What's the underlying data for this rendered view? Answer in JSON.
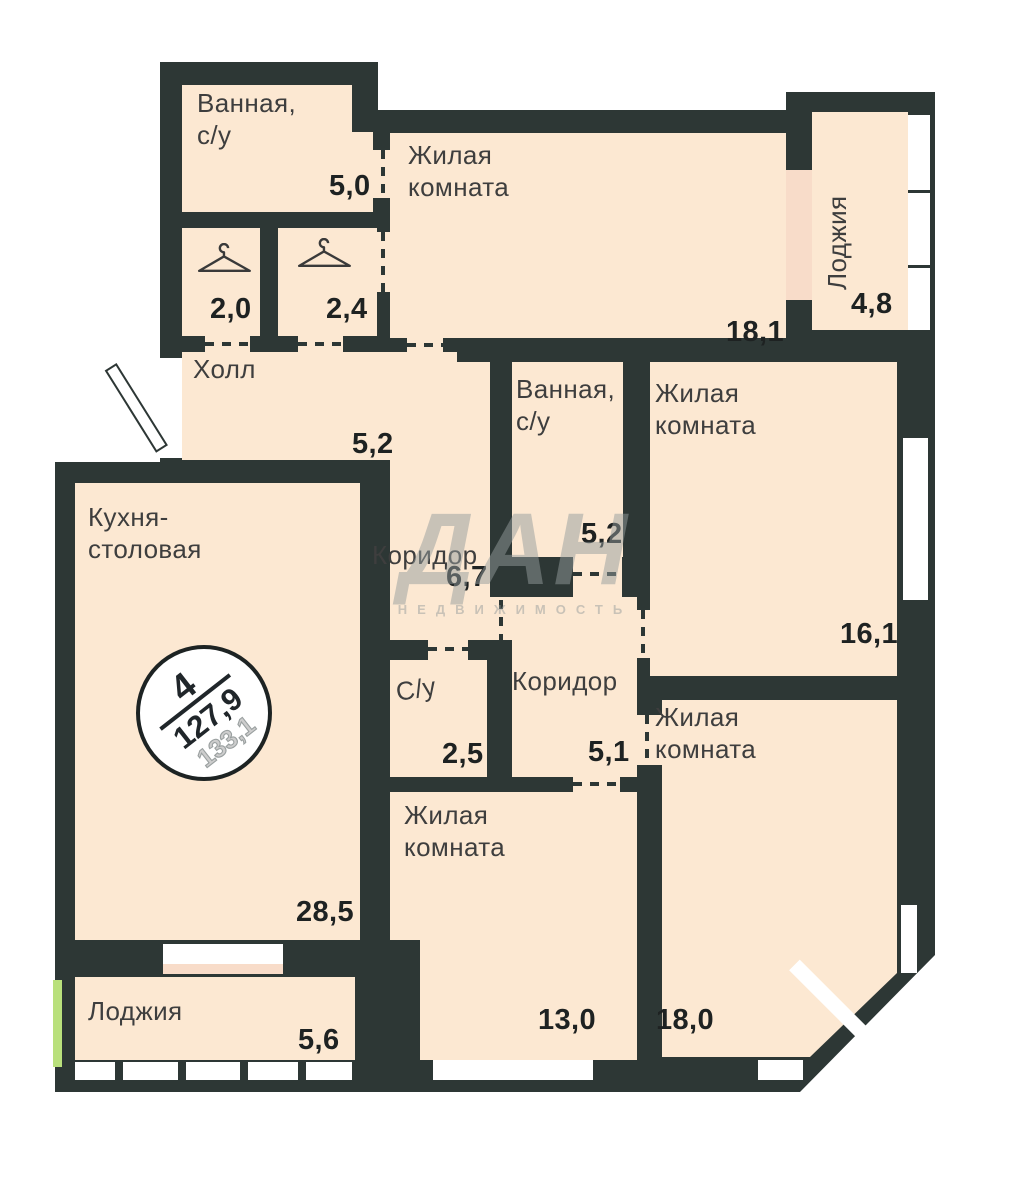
{
  "watermark": {
    "logo": "ДАН",
    "subtitle": "НЕДВИЖИМОСТЬ"
  },
  "badge": {
    "rooms_count": "4",
    "area_living": "127,9",
    "area_total": "133,1"
  },
  "rooms": [
    {
      "name": "bathroom-top",
      "label": "Ванная,\nс/у",
      "area": "5,0"
    },
    {
      "name": "wardrobe-left",
      "label": "",
      "area": "2,0"
    },
    {
      "name": "wardrobe-right",
      "label": "",
      "area": "2,4"
    },
    {
      "name": "living-room-top",
      "label": "Жилая\nкомната",
      "area": "18,1"
    },
    {
      "name": "loggia-top",
      "label": "Лоджия",
      "area": "4,8"
    },
    {
      "name": "hall",
      "label": "Холл",
      "area": "5,2"
    },
    {
      "name": "kitchen-dining",
      "label": "Кухня-\nстоловая",
      "area": "28,5"
    },
    {
      "name": "corridor-upper",
      "label": "Коридор",
      "area": "6,7"
    },
    {
      "name": "bathroom-middle",
      "label": "Ванная,\nс/у",
      "area": "5,2"
    },
    {
      "name": "living-room-right",
      "label": "Жилая\nкомната",
      "area": "16,1"
    },
    {
      "name": "wc",
      "label": "С/у",
      "area": "2,5"
    },
    {
      "name": "corridor-lower",
      "label": "Коридор",
      "area": "5,1"
    },
    {
      "name": "living-room-bottom",
      "label": "Жилая\nкомната",
      "area": "13,0"
    },
    {
      "name": "living-room-bottom-right",
      "label": "Жилая\nкомната",
      "area": "18,0"
    },
    {
      "name": "loggia-bottom",
      "label": "Лоджия",
      "area": "5,6"
    }
  ],
  "colors": {
    "wall": "#2d3735",
    "floor": "#fce8d2",
    "balcony_door": "#f8dcc9",
    "accent_green": "#b9e07c"
  }
}
